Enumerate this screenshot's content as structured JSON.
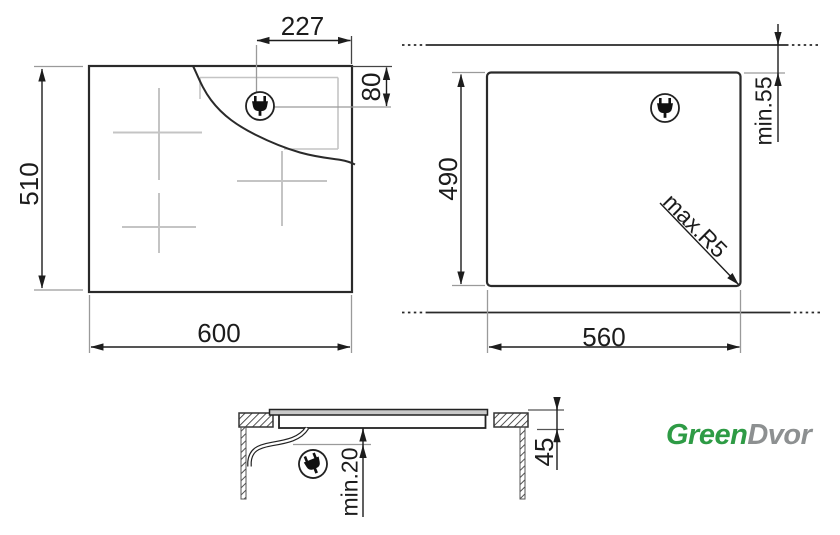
{
  "drawing": {
    "top_view": {
      "width": "600",
      "depth": "510",
      "plug_offset_from_right_edge": "227",
      "plug_offset_from_top_edge": "80",
      "icon": "power-plug-icon"
    },
    "cutout_view": {
      "width": "560",
      "depth": "490",
      "min_wall_distance": "min.55",
      "max_corner_radius": "max.R5",
      "icon": "power-plug-icon"
    },
    "side_view": {
      "built_in_height": "45",
      "min_bottom_clearance": "min.20",
      "icon": "power-plug-icon"
    }
  },
  "logo": {
    "text_green": "Green",
    "text_gray": "Dvor",
    "green_color": "#2e9b45",
    "gray_color": "#8d9091"
  },
  "colors": {
    "main_line": "#2a2a2a",
    "light_line": "#c4c4c4",
    "leader_line": "#9a9a9a",
    "background": "#ffffff"
  }
}
